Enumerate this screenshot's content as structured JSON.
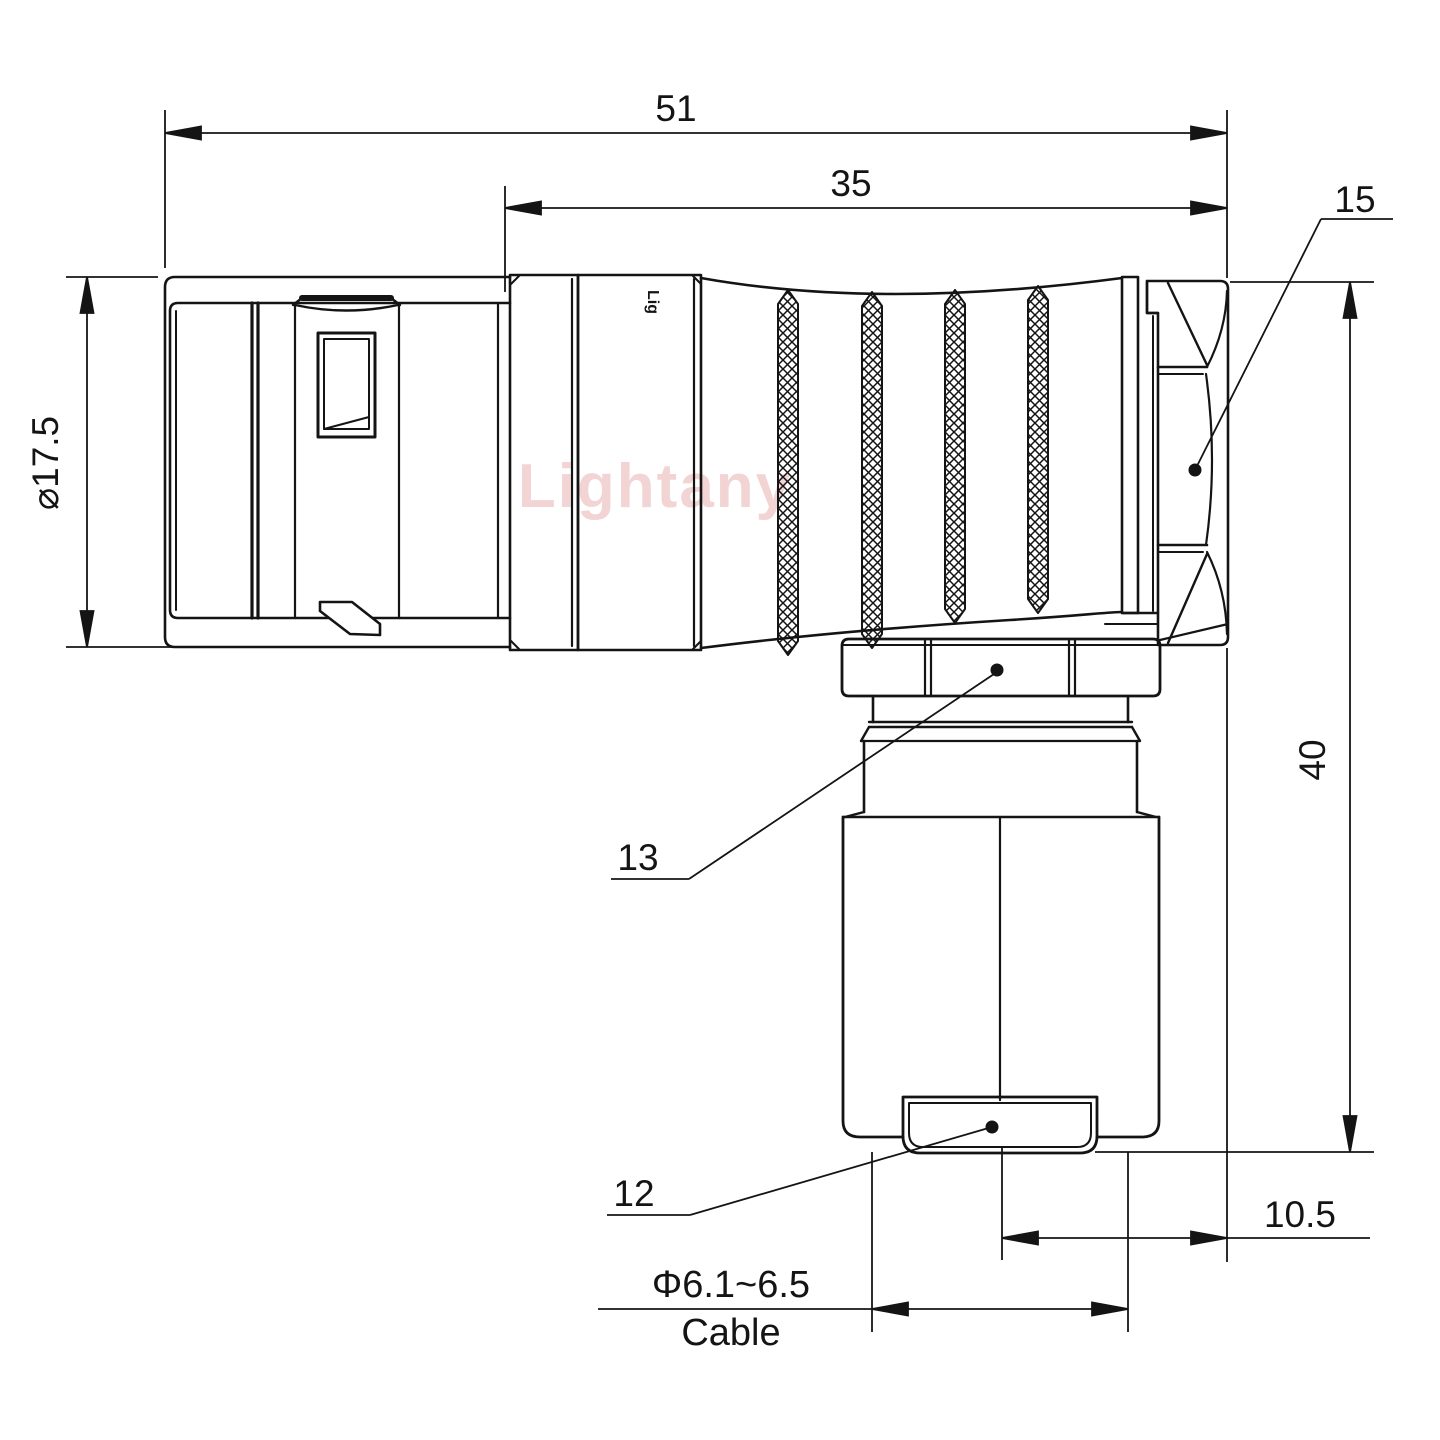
{
  "drawing": {
    "type": "technical-drawing",
    "subject": "right-angle elbow cable connector, side elevation with dimensions",
    "colors": {
      "line": "#141414",
      "background": "#ffffff",
      "watermark_pink": "#e8b2b2"
    },
    "watermark": "Lightany",
    "body_marking": "Lig",
    "dimensions": {
      "overall_length": "51",
      "rear_body_length": "35",
      "front_diameter": "⌀17.5",
      "overall_height": "40",
      "elbow_offset": "10.5",
      "cable_range": "Φ6.1~6.5",
      "cable_word": "Cable"
    },
    "part_labels": {
      "backshell_nut": "15",
      "coupling_nut": "13",
      "cable_bushing": "12"
    }
  }
}
